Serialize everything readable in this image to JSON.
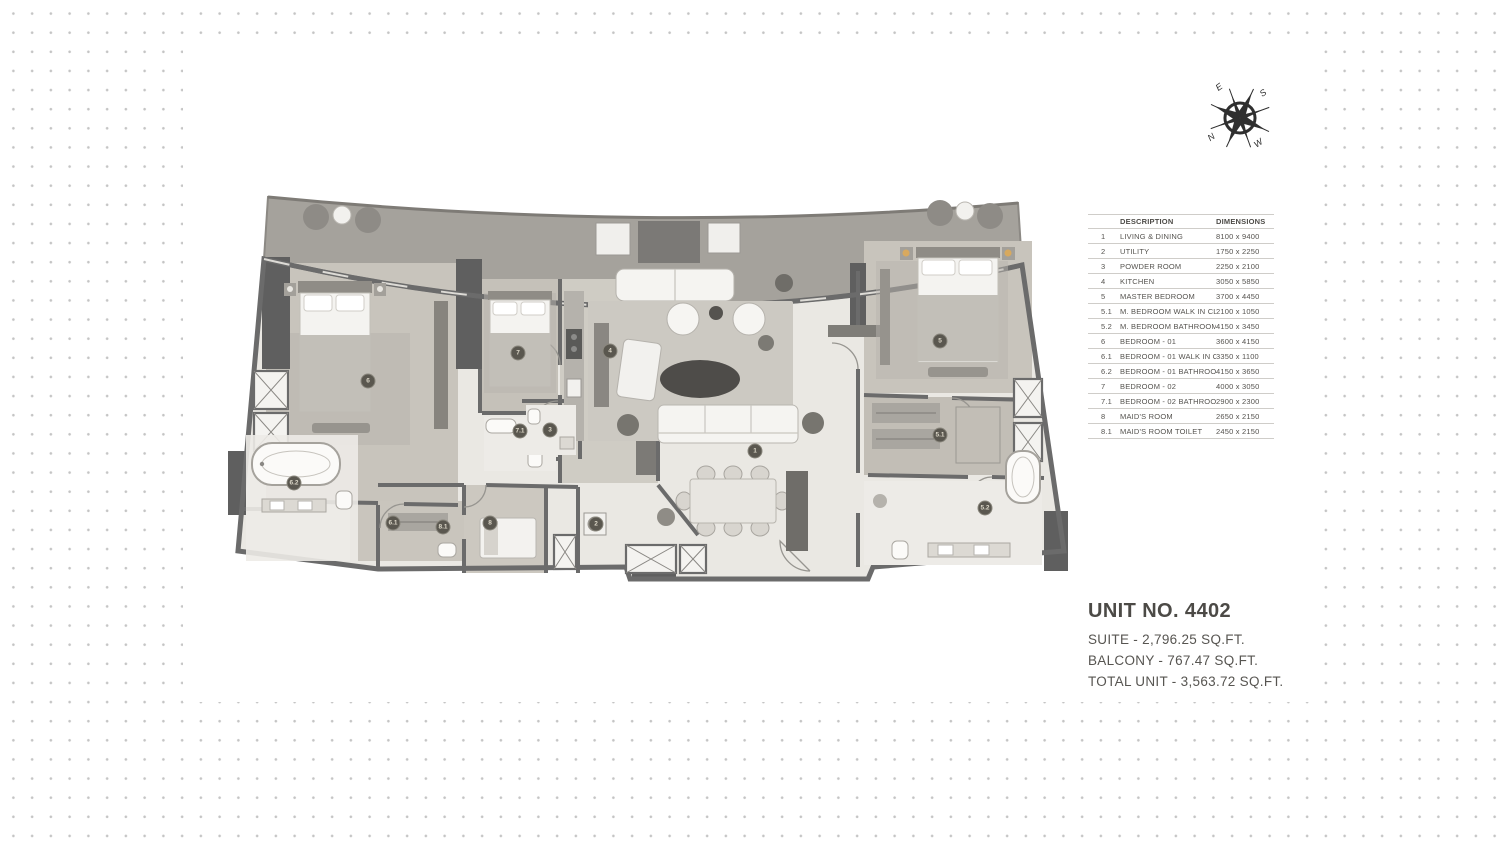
{
  "compass": {
    "n": "N",
    "e": "E",
    "s": "S",
    "w": "W"
  },
  "legend_table": {
    "header": {
      "no": "",
      "description": "DESCRIPTION",
      "dimensions": "DIMENSIONS"
    },
    "rows": [
      {
        "no": "1",
        "description": "LIVING & DINING",
        "dimensions": "8100 x 9400"
      },
      {
        "no": "2",
        "description": "UTILITY",
        "dimensions": "1750 x 2250"
      },
      {
        "no": "3",
        "description": "POWDER ROOM",
        "dimensions": "2250 x 2100"
      },
      {
        "no": "4",
        "description": "KITCHEN",
        "dimensions": "3050 x 5850"
      },
      {
        "no": "5",
        "description": "MASTER BEDROOM",
        "dimensions": "3700 x 4450"
      },
      {
        "no": "5.1",
        "description": "M. BEDROOM WALK IN CLOSET",
        "dimensions": "2100 x 1050"
      },
      {
        "no": "5.2",
        "description": "M. BEDROOM BATHROOM",
        "dimensions": "4150 x 3450"
      },
      {
        "no": "6",
        "description": "BEDROOM - 01",
        "dimensions": "3600 x 4150"
      },
      {
        "no": "6.1",
        "description": "BEDROOM - 01 WALK IN CLOSET",
        "dimensions": "3350 x 1100"
      },
      {
        "no": "6.2",
        "description": "BEDROOM - 01 BATHROOM",
        "dimensions": "4150 x 3650"
      },
      {
        "no": "7",
        "description": "BEDROOM - 02",
        "dimensions": "4000 x 3050"
      },
      {
        "no": "7.1",
        "description": "BEDROOM - 02 BATHROOM",
        "dimensions": "2900 x 2300"
      },
      {
        "no": "8",
        "description": "MAID'S ROOM",
        "dimensions": "2650 x 2150"
      },
      {
        "no": "8.1",
        "description": "MAID'S ROOM TOILET",
        "dimensions": "2450 x 2150"
      }
    ]
  },
  "unit_info": {
    "title": "UNIT NO. 4402",
    "suite": "SUITE - 2,796.25 SQ.FT.",
    "balcony": "BALCONY - 767.47 SQ.FT.",
    "total": "TOTAL UNIT - 3,563.72 SQ.FT."
  },
  "floorplan": {
    "badges": [
      {
        "label": "1"
      },
      {
        "label": "2"
      },
      {
        "label": "3"
      },
      {
        "label": "4"
      },
      {
        "label": "5"
      },
      {
        "label": "5.1"
      },
      {
        "label": "5.2"
      },
      {
        "label": "6"
      },
      {
        "label": "6.1"
      },
      {
        "label": "6.2"
      },
      {
        "label": "7"
      },
      {
        "label": "7.1"
      },
      {
        "label": "8"
      },
      {
        "label": "8.1"
      }
    ]
  },
  "colors": {
    "wall": "#6b6b6b",
    "wood_floor": "#c8c4bc",
    "balcony_wood": "#a5a29c",
    "marble_floor": "#eae8e3",
    "dot": "#c4c4c4",
    "badge_bg": "#5a574f"
  }
}
